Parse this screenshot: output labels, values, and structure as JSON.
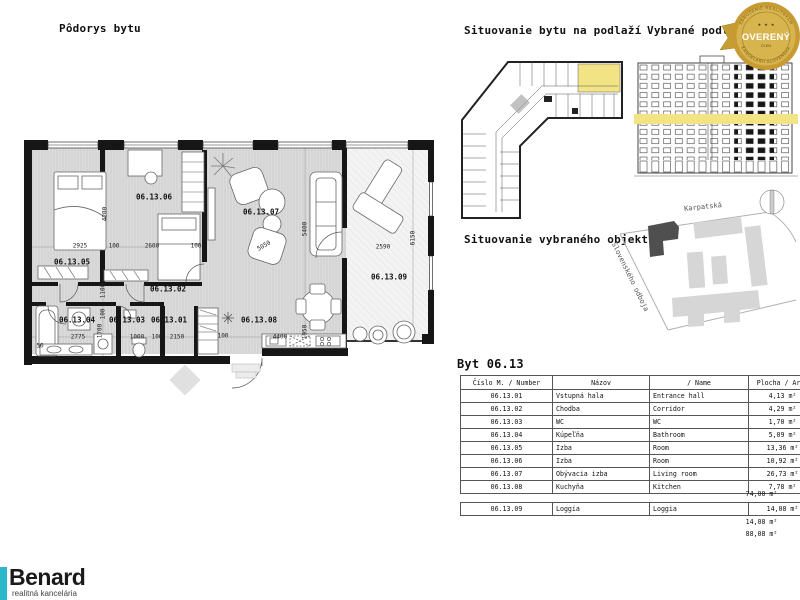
{
  "titles": {
    "plan": "Pôdorys bytu",
    "floor_location": "Situovanie bytu na podlaží",
    "selected_floor": "Vybrané podlažie",
    "object_location": "Situovanie vybraného objektu"
  },
  "badge": {
    "association_top": "ZDRUŽENIE REALITNÝCH",
    "stars": "★ ★ ★",
    "main": "OVERENÝ",
    "member": "ČLEN",
    "association_bottom": "KANCELÁRIÍ SLOVENSKA"
  },
  "plan": {
    "rooms": [
      "06.13.05",
      "06.13.06",
      "06.13.07",
      "06.13.09",
      "06.13.02",
      "06.13.04",
      "06.13.03",
      "06.13.01",
      "06.13.08"
    ],
    "dims": [
      "2925",
      "100",
      "2600",
      "100",
      "5050",
      "2590",
      "2775",
      "1000",
      "100",
      "2150",
      "100",
      "4400",
      "4200",
      "5400",
      "6150",
      "1100",
      "100",
      "1700",
      "1950",
      "50"
    ]
  },
  "map": {
    "street_top": "Karpatská",
    "street_side": "Slovenského odboja"
  },
  "table": {
    "title": "Byt 06.13",
    "headers": [
      "Číslo M. / Number",
      "Názov",
      "/ Name",
      "Plocha / Area"
    ],
    "rows": [
      {
        "number": "06.13.01",
        "nazov": "Vstupná hala",
        "name": "Entrance hall",
        "area": "4,13 m²"
      },
      {
        "number": "06.13.02",
        "nazov": "Chodba",
        "name": "Corridor",
        "area": "4,29 m²"
      },
      {
        "number": "06.13.03",
        "nazov": "WC",
        "name": "WC",
        "area": "1,70 m²"
      },
      {
        "number": "06.13.04",
        "nazov": "Kúpeľňa",
        "name": "Bathroom",
        "area": "5,09 m²"
      },
      {
        "number": "06.13.05",
        "nazov": "Izba",
        "name": "Room",
        "area": "13,36 m²"
      },
      {
        "number": "06.13.06",
        "nazov": "Izba",
        "name": "Room",
        "area": "10,92 m²"
      },
      {
        "number": "06.13.07",
        "nazov": "Obývacia izba",
        "name": "Living room",
        "area": "26,73 m²"
      },
      {
        "number": "06.13.08",
        "nazov": "Kuchyňa",
        "name": "Kitchen",
        "area": "7,78 m²"
      }
    ],
    "subtotal_interior": "74,00 m²",
    "loggia_row": {
      "number": "06.13.09",
      "nazov": "Loggia",
      "name": "Loggia",
      "area": "14,08 m²"
    },
    "subtotal_loggia": "14,08 m²",
    "total": "88,08 m²"
  },
  "logo": {
    "name": "Benard",
    "subtitle": "realitná kancelária"
  },
  "colors": {
    "highlight": "#f2e385",
    "badge_gold": "#c89b32",
    "logo_teal": "#29b7c9",
    "selected_building": "#4f4f4f"
  }
}
